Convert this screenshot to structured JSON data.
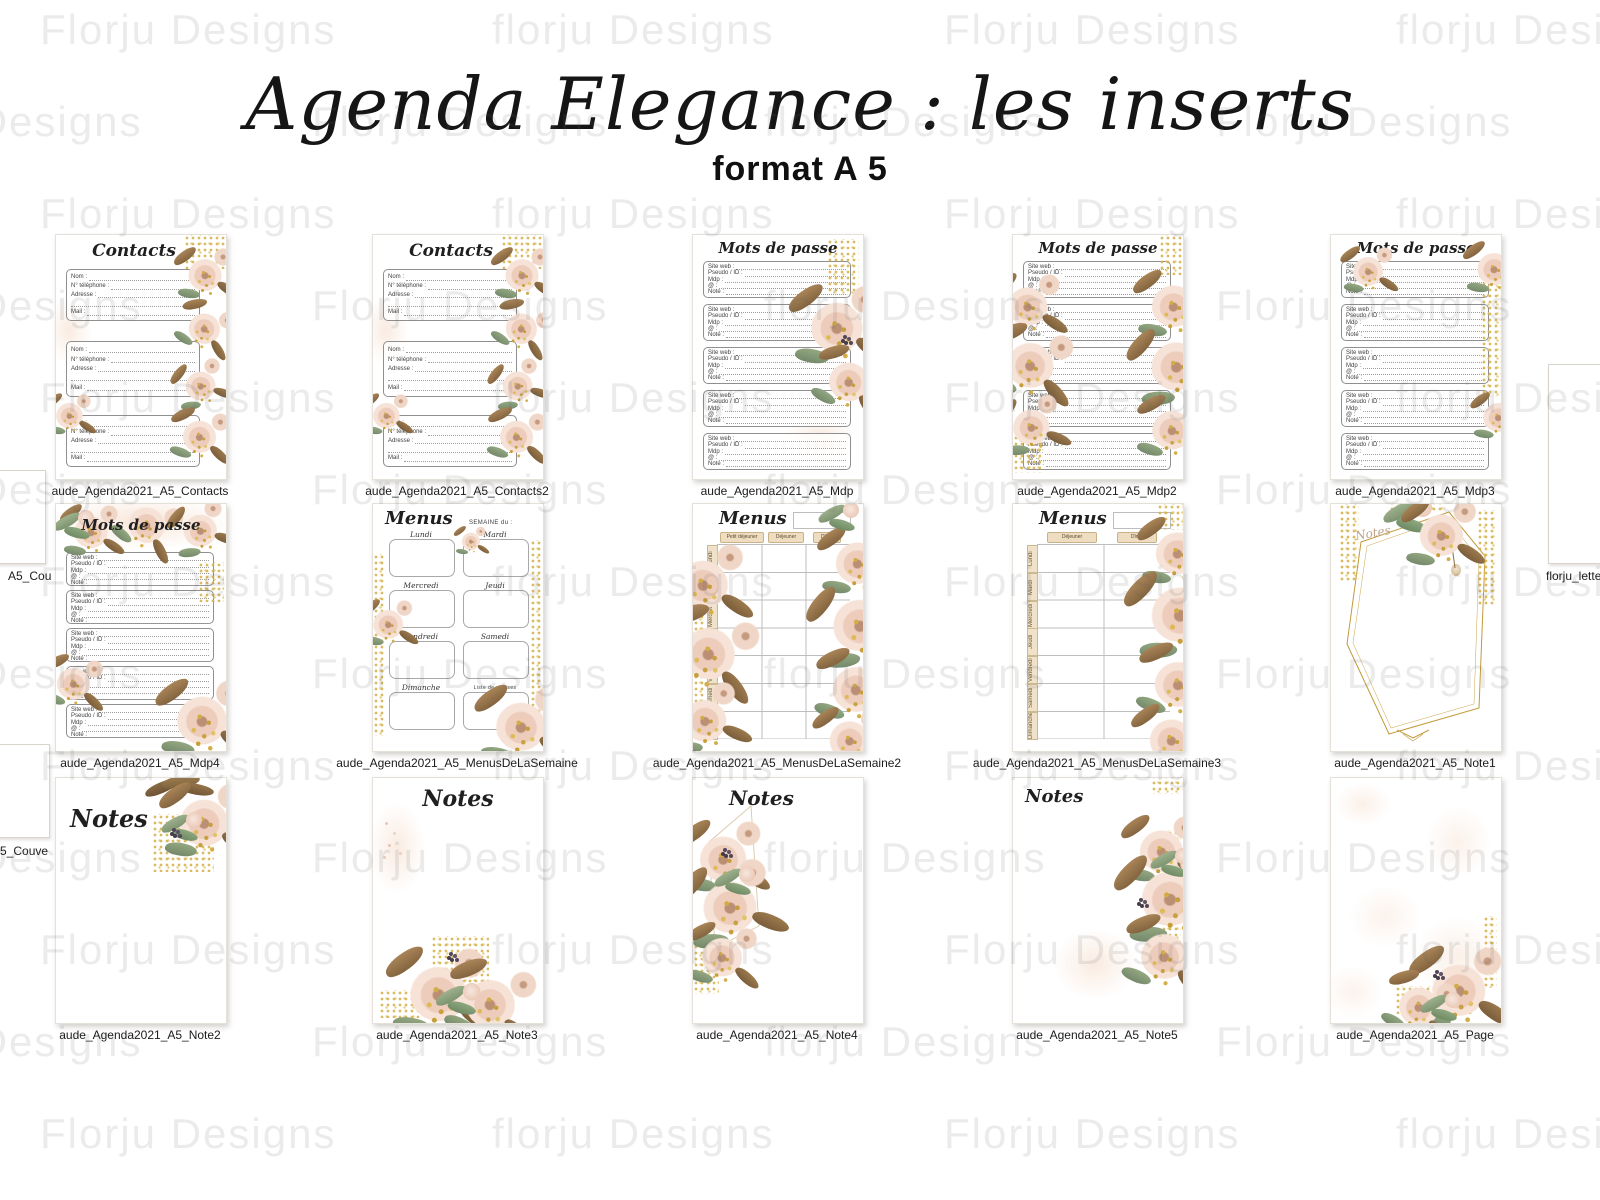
{
  "header": {
    "title": "Agenda Elegance : les inserts",
    "subtitle": "format A 5"
  },
  "watermark": {
    "variants": [
      "Florju Designs",
      "florju Designs"
    ]
  },
  "edge_partials": {
    "left_mid_label": "A5_Cou",
    "left_bottom_label": "5_Couve",
    "right_mid_label": "florju_lette"
  },
  "page_texts": {
    "contacts_title": "Contacts",
    "mdp_title": "Mots de passe",
    "menus_title": "Menus",
    "notes_title": "Notes",
    "semaine_label": "SEMAINE du :",
    "liste_courses": "Liste de courses",
    "days": [
      "Lundi",
      "Mardi",
      "Mercredi",
      "Jeudi",
      "Vendredi",
      "Samedi",
      "Dimanche"
    ],
    "contact_fields": [
      "Nom :",
      "N° téléphone :",
      "Adresse :",
      "",
      "Mail :"
    ],
    "mdp_fields": [
      "Site web :",
      "Pseudo / ID :",
      "Mdp :",
      "@ :",
      "Note :"
    ],
    "menus2_headers": [
      "Petit déjeuner",
      "Déjeuner",
      "Dîner"
    ],
    "menus3_headers": [
      "Déjeuner",
      "Dîner"
    ]
  },
  "colors": {
    "gold": "#cda74a",
    "blush": "#f0d6c9",
    "brown": "#97744d",
    "green": "#8fa682",
    "watermark_gray": "#e9e9e9"
  },
  "thumbnails": [
    {
      "label": "aude_Agenda2021_A5_Contacts",
      "type": "contacts"
    },
    {
      "label": "aude_Agenda2021_A5_Contacts2",
      "type": "contacts2"
    },
    {
      "label": "aude_Agenda2021_A5_Mdp",
      "type": "mdp"
    },
    {
      "label": "aude_Agenda2021_A5_Mdp2",
      "type": "mdp2"
    },
    {
      "label": "aude_Agenda2021_A5_Mdp3",
      "type": "mdp3"
    },
    {
      "label": "aude_Agenda2021_A5_Mdp4",
      "type": "mdp4"
    },
    {
      "label": "aude_Agenda2021_A5_MenusDeLaSemaine",
      "type": "menus"
    },
    {
      "label": "aude_Agenda2021_A5_MenusDeLaSemaine2",
      "type": "menus2"
    },
    {
      "label": "aude_Agenda2021_A5_MenusDeLaSemaine3",
      "type": "menus3"
    },
    {
      "label": "aude_Agenda2021_A5_Note1",
      "type": "note1"
    },
    {
      "label": "aude_Agenda2021_A5_Note2",
      "type": "note2"
    },
    {
      "label": "aude_Agenda2021_A5_Note3",
      "type": "note3"
    },
    {
      "label": "aude_Agenda2021_A5_Note4",
      "type": "note4"
    },
    {
      "label": "aude_Agenda2021_A5_Note5",
      "type": "note5"
    },
    {
      "label": "aude_Agenda2021_A5_Page",
      "type": "page"
    }
  ]
}
